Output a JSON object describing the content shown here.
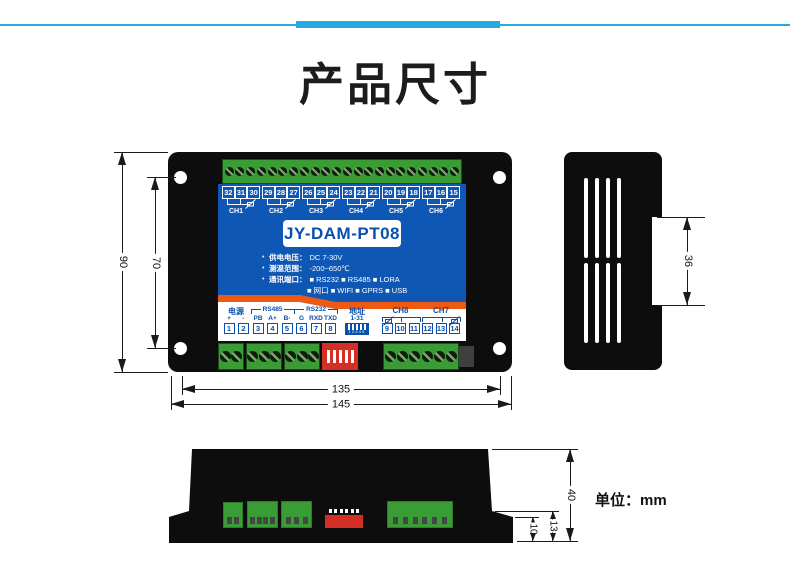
{
  "page": {
    "title": "产品尺寸",
    "unit_label": "单位：mm"
  },
  "device": {
    "model": "JY-DAM-PT08",
    "specs": [
      {
        "label": "供电电压：",
        "value": "DC 7-30V"
      },
      {
        "label": "测温范围：",
        "value": "-200~650℃"
      },
      {
        "label": "通讯端口：",
        "value": "■ RS232 ■ RS485 ■ LORA",
        "value2": "■ 网口  ■ WIFI  ■ GPRS ■ USB"
      }
    ],
    "top_channels": [
      {
        "label": "CH1",
        "terminals": [
          "32",
          "31",
          "30"
        ]
      },
      {
        "label": "CH2",
        "terminals": [
          "29",
          "28",
          "27"
        ]
      },
      {
        "label": "CH3",
        "terminals": [
          "26",
          "25",
          "24"
        ]
      },
      {
        "label": "CH4",
        "terminals": [
          "23",
          "22",
          "21"
        ]
      },
      {
        "label": "CH5",
        "terminals": [
          "20",
          "19",
          "18"
        ]
      },
      {
        "label": "CH6",
        "terminals": [
          "17",
          "16",
          "15"
        ]
      }
    ],
    "bottom_groups": {
      "power": {
        "label": "电源",
        "pins": [
          "+",
          "-"
        ],
        "terminals": [
          "1",
          "2"
        ]
      },
      "rs485": {
        "label": "RS485",
        "pins": [
          "PB",
          "A+",
          "B-"
        ],
        "terminals": [
          "3",
          "4",
          "5"
        ]
      },
      "rs232": {
        "label": "RS232",
        "pins": [
          "G",
          "RXD",
          "TXD"
        ],
        "terminals": [
          "6",
          "7",
          "8"
        ]
      },
      "address": {
        "label": "地址",
        "range": "1-31",
        "dip_numbers": "12345"
      },
      "ch8": {
        "label": "CH8",
        "terminals": [
          "9",
          "10",
          "11"
        ]
      },
      "ch7": {
        "label": "CH7",
        "terminals": [
          "12",
          "13",
          "14"
        ]
      }
    }
  },
  "dimensions": {
    "front": {
      "height": "90",
      "hole_spacing": "70",
      "width_inner": "135",
      "width_outer": "145"
    },
    "side": {
      "rail_clip_height": "36"
    },
    "bottom": {
      "height": "40",
      "terminal_depth": "13",
      "base_depth": "10"
    }
  },
  "colors": {
    "faceplate_blue": "#0e57b5",
    "stripe_orange": "#ee5a11",
    "terminal_green": "#3a9c35",
    "dip_red": "#d22f27",
    "divider_blue": "#29a9e1",
    "body_black": "#0d0d0d",
    "label_blue": "#0a4fae"
  }
}
